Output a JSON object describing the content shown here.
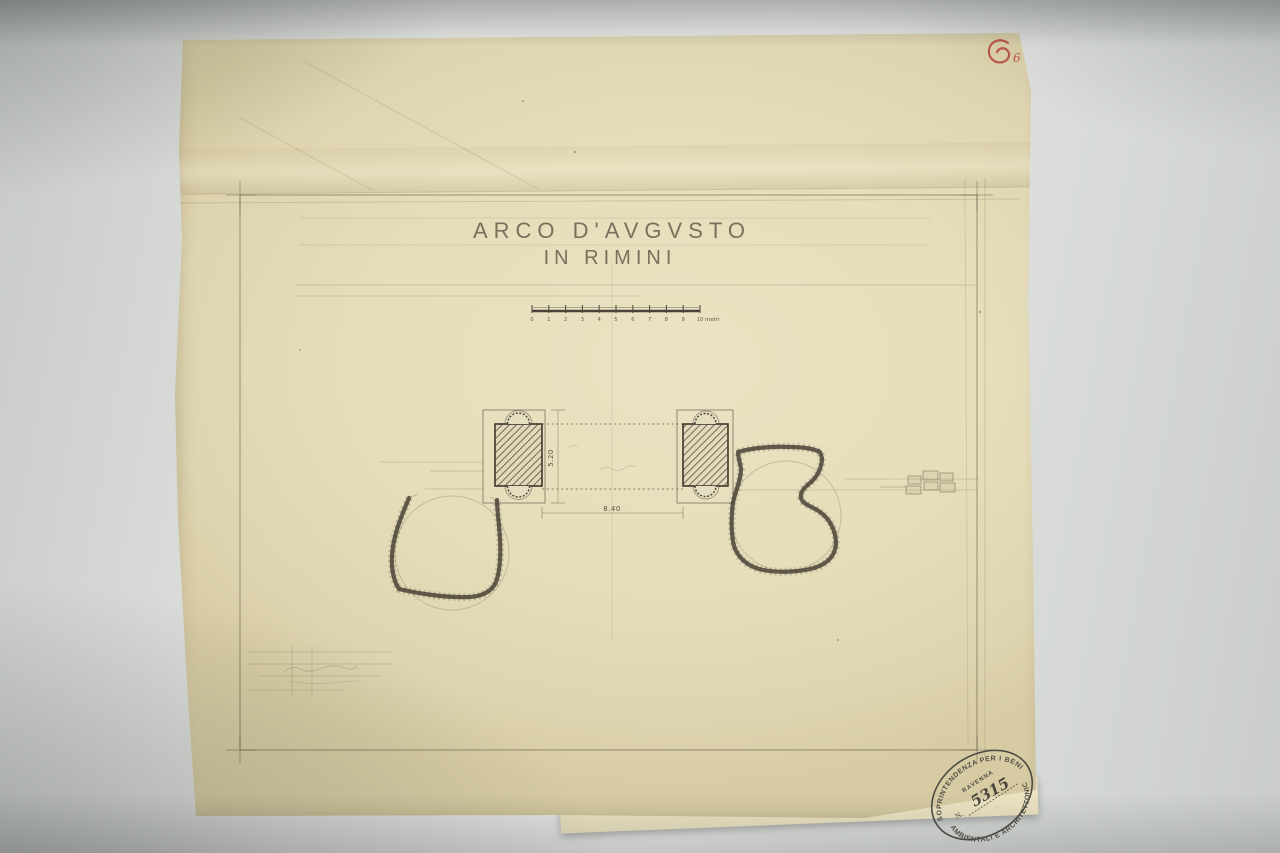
{
  "document": {
    "title_line1": "ARCO D'AVGVSTO",
    "title_line2": "IN RIMINI"
  },
  "scale": {
    "ticks": [
      "0",
      "1",
      "2",
      "3",
      "4",
      "5",
      "6",
      "7",
      "8",
      "9",
      "10"
    ],
    "unit": "metri"
  },
  "dimensions": {
    "opening_width": "8.40",
    "pylon_depth": "5.20"
  },
  "stamp": {
    "arc_top": "SOPRINTENDENZA PER I BENI",
    "arc_bottom": "AMBIENTALI E ARCHITETTONICI",
    "city": "RAVENNA",
    "number_prefix": "N.",
    "number": "5315",
    "caption": "········"
  },
  "annotations": {
    "red_number": "6"
  },
  "colors": {
    "paper": "#e6ddba",
    "background": "#dcdedb",
    "ink": "#423c30",
    "pencil": "#6b6351",
    "stamp_ink": "#3f3d38",
    "red_annotation": "#b5433c"
  }
}
